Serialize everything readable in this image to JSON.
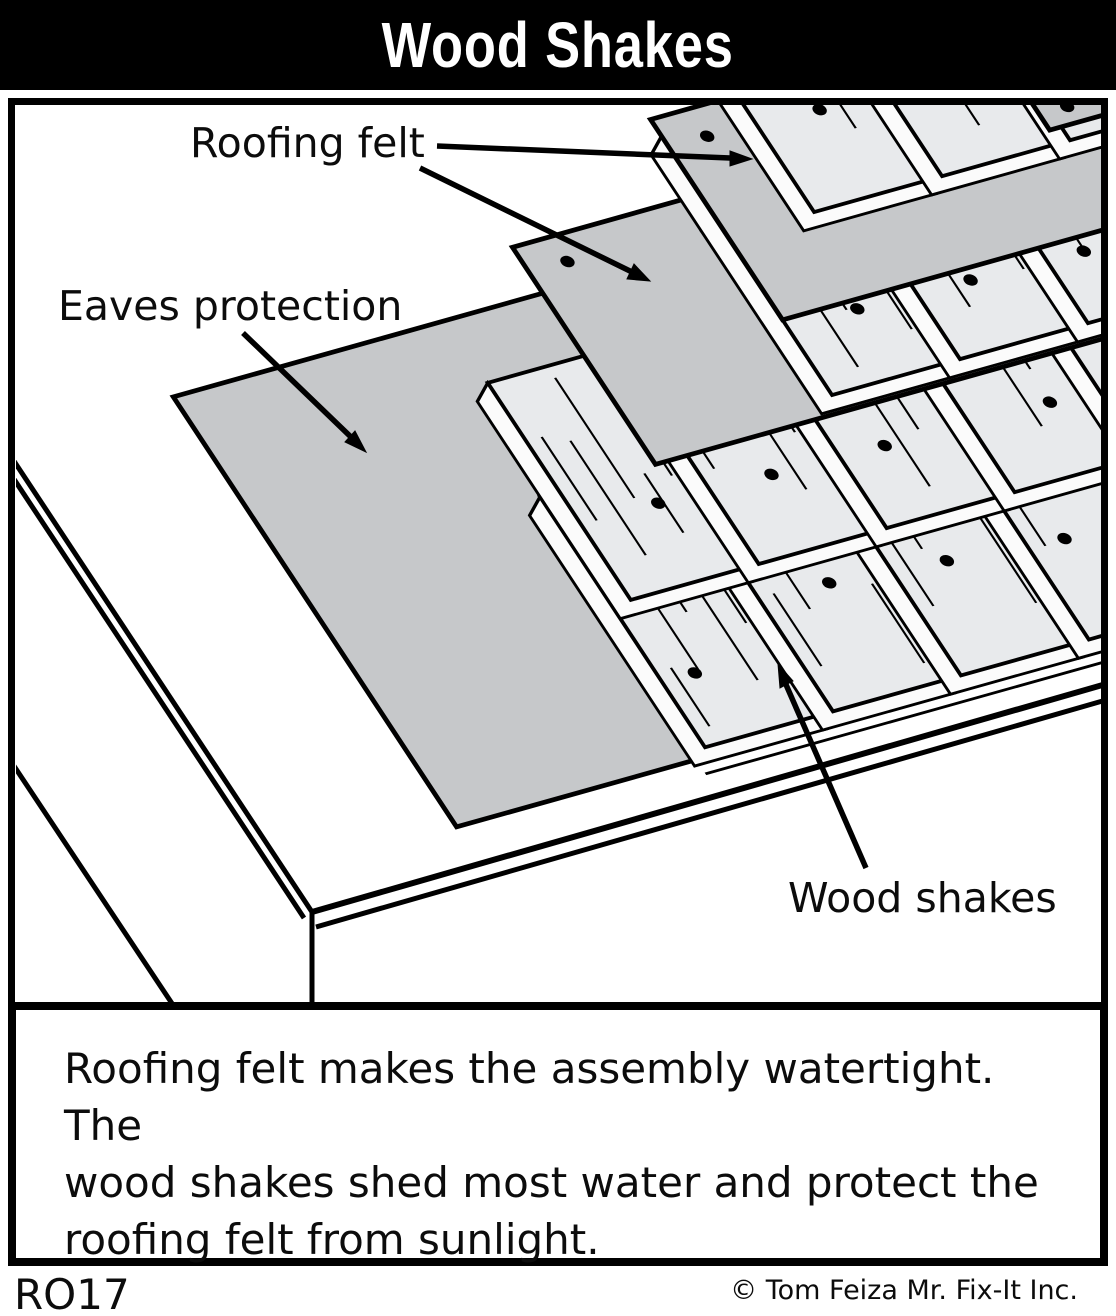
{
  "title": "Wood Shakes",
  "figure_code": "RO17",
  "labels": {
    "roofing_felt": "Roofing felt",
    "eaves_protection": "Eaves protection",
    "wood_shakes": "Wood shakes"
  },
  "caption": {
    "line1": "Roofing felt makes the assembly watertight.  The",
    "line2": "wood shakes shed most water and protect the",
    "line3": "roofing felt from sunlight.",
    "credit": "© Tom Feiza Mr. Fix-It Inc."
  },
  "colors": {
    "felt_gray": "#c6c8ca",
    "shake_gray": "#e8eaec",
    "bevel_white": "#fbfbfb",
    "outline": "#000000",
    "title_bg": "#000000",
    "title_text": "#ffffff",
    "paper": "#ffffff"
  }
}
